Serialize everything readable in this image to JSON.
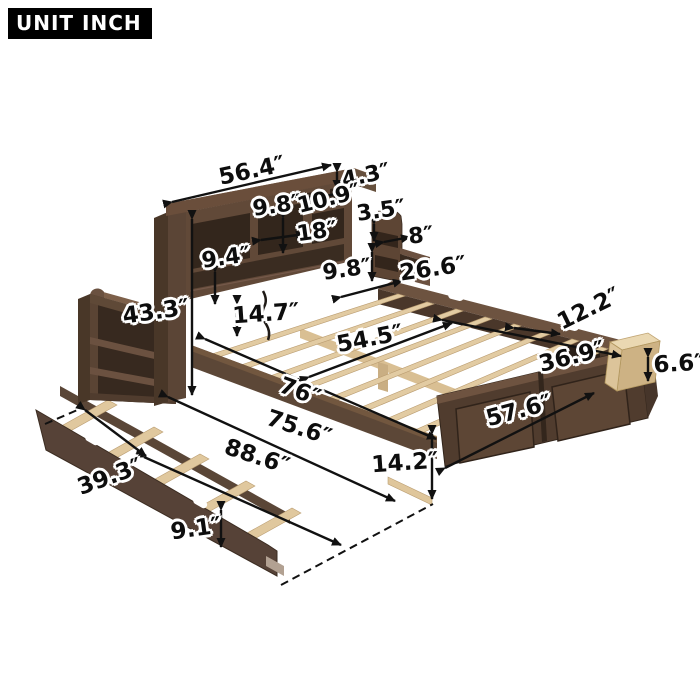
{
  "unit_label": "UNIT INCH",
  "dims": {
    "headboard_width": "56.4″",
    "top_shelf_height": "4.3″",
    "cubby_height": "9.8″",
    "top_cubby_width": "10.9″",
    "right_shelf_lip_height": "3.5″",
    "cubby_width": "18″",
    "right_shelf_depth": "8″",
    "left_cubby_height": "9.4″",
    "right_shelf_height": "9.8″",
    "side_section_width": "26.6″",
    "headboard_height": "43.3″",
    "under_headboard_clearance": "14.7″",
    "slat_area_width": "54.5″",
    "drawer_section_length": "12.2″",
    "storage_rail_length": "36.9″",
    "drawer_height": "6.6″",
    "bed_length": "76″",
    "bed_width": "57.6″",
    "trundle_length": "75.6″",
    "overall_length": "88.6″",
    "side_rail_height": "14.2″",
    "trundle_width": "39.3″",
    "trundle_height": "9.1″"
  },
  "colors": {
    "wood_dark": "#493728",
    "wood_mid": "#5f4937",
    "wood_top": "#7e614a",
    "cubby_shadow": "#33261c",
    "slat": "#e2cba2",
    "drawer_wood": "#cdb284",
    "label": "#0d0d0d",
    "halo": "#ffffff",
    "unit_box_bg": "#000000",
    "unit_box_text": "#ffffff"
  }
}
